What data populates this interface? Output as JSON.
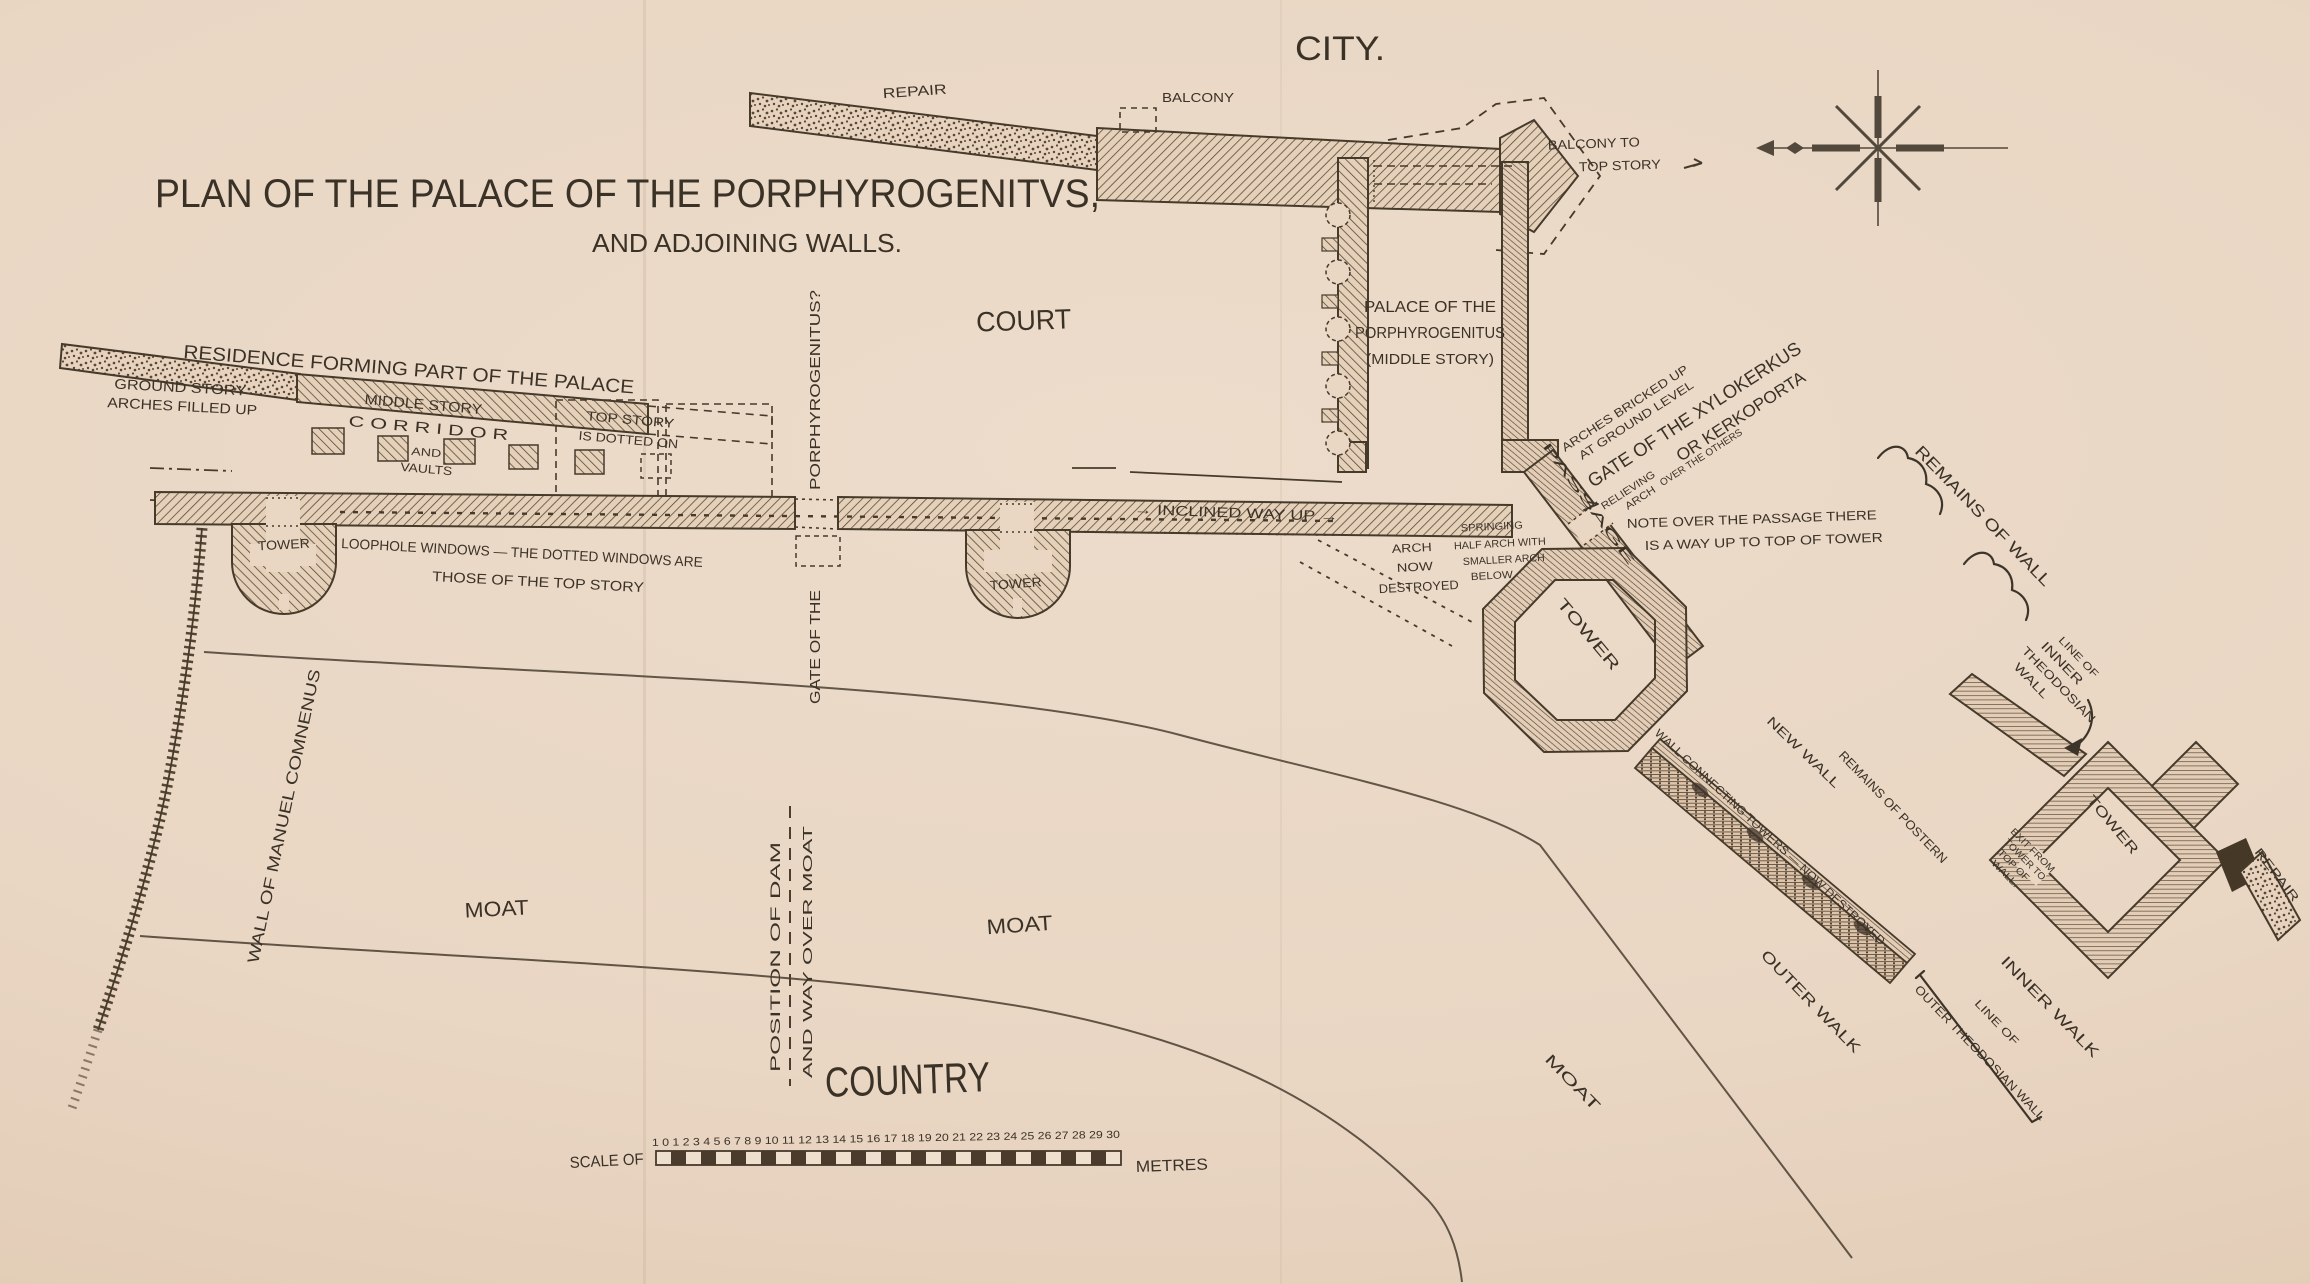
{
  "title": {
    "line1": "PLAN OF THE PALACE OF THE PORPHYROGENITVS,",
    "line2": "AND ADJOINING WALLS."
  },
  "areas": {
    "city": "CITY.",
    "court": "COURT",
    "country": "COUNTRY",
    "moat_left": "MOAT",
    "moat_mid": "MOAT",
    "moat_right": "MOAT"
  },
  "labels": {
    "repair_top": "REPAIR",
    "balcony": "BALCONY",
    "balcony_to_1": "BALCONY TO",
    "balcony_to_2": "TOP STORY",
    "residence": "RESIDENCE FORMING PART OF THE PALACE",
    "ground_story_1": "GROUND STORY",
    "ground_story_2": "ARCHES FILLED UP",
    "middle_story": "MIDDLE STORY",
    "corridor": "C O R R I D O R",
    "corridor_and": "AND",
    "corridor_vaults": "VAULTS",
    "top_story_1": "TOP STORY",
    "top_story_2": "IS DOTTED ON",
    "tower_left": "TOWER",
    "tower_mid": "TOWER",
    "tower_oct": "TOWER",
    "tower_right": "TOWER",
    "loophole_1": "LOOPHOLE WINDOWS — THE DOTTED WINDOWS ARE",
    "loophole_2": "THOSE OF THE TOP STORY",
    "gate_porph_1": "PORPHYROGENITUS?",
    "gate_porph_2": "GATE OF THE",
    "inclined_way": "→ INCLINED WAY UP →",
    "palace_1": "PALACE OF THE",
    "palace_2": "PORPHYROGENITUS",
    "palace_3": "(MIDDLE STORY)",
    "arches_bricked_1": "ARCHES BRICKED UP",
    "arches_bricked_2": "AT GROUND LEVEL",
    "xylokerkus_1": "GATE OF THE XYLOKERKUS",
    "xylokerkus_2": "OR KERKOPORTA",
    "relieving_1": "RELIEVING",
    "relieving_2": "ARCH",
    "relieving_3": "OVER THE OTHERS",
    "note_1": "NOTE OVER THE PASSAGE THERE",
    "note_2": "IS A WAY UP TO TOP OF TOWER",
    "passage": "PASSAGE",
    "arch_destroyed_1": "ARCH",
    "arch_destroyed_2": "NOW",
    "arch_destroyed_3": "DESTROYED",
    "springing_1": "SPRINGING",
    "springing_2": "HALF ARCH WITH",
    "springing_3": "SMALLER ARCH",
    "springing_4": "BELOW",
    "remains_wall": "REMAINS OF WALL",
    "line_inner_1": "LINE OF",
    "line_inner_2": "INNER",
    "line_inner_3": "THEODOSIAN",
    "line_inner_4": "WALL",
    "new_wall": "NEW WALL",
    "wall_connecting": "WALL CONNECTING TOWERS — NOW DESTROYED",
    "remains_postern": "REMAINS OF POSTERN",
    "exit_1": "EXIT FROM",
    "exit_2": "TOWER TO",
    "exit_3": "TOP OF",
    "exit_4": "WALL.",
    "repair_right": "REPAIR",
    "inner_walk": "INNER WALK",
    "outer_walk": "OUTER WALK",
    "line_outer_1": "LINE OF",
    "line_outer_2": "OUTER THEODOSIAN WALL",
    "wall_manuel": "WALL OF MANUEL COMNENUS",
    "position_dam_1": "POSITION OF DAM",
    "position_dam_2": "AND WAY OVER MOAT"
  },
  "scale_bar": {
    "prefix": "SCALE OF",
    "ticks": "1 0 1 2 3 4 5 6 7 8 9 10 11 12 13 14 15 16 17 18 19 20 21 22 23 24 25 26 27 28 29 30",
    "unit": "METRES"
  },
  "colors": {
    "paper": "#e9d6c3",
    "ink": "#3b3227",
    "wall_hatch": "#4f4233"
  }
}
